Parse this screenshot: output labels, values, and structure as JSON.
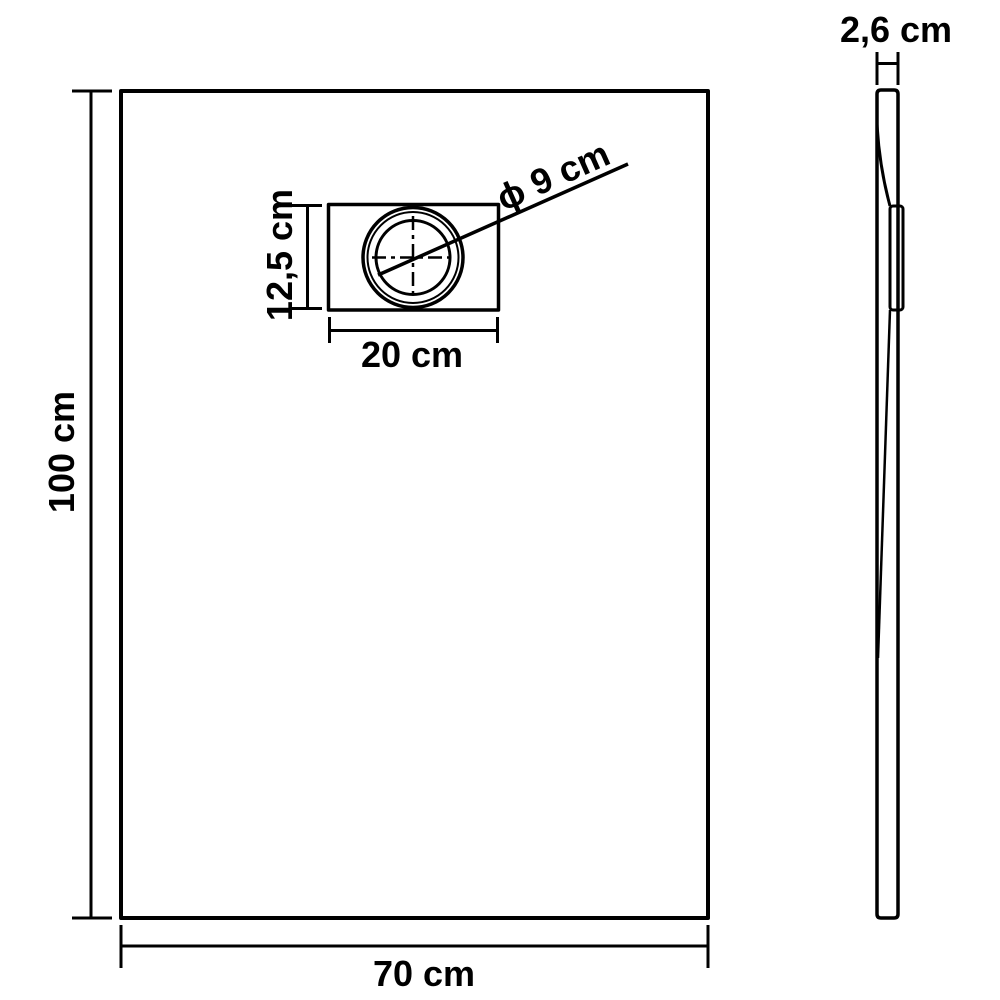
{
  "diagram": {
    "title": "shower tray dimensional drawing",
    "colors": {
      "line": "#000000",
      "background": "#ffffff",
      "text": "#000000"
    },
    "front_view": {
      "height_label": "100 cm",
      "width_label": "70 cm",
      "drain_height_label": "12,5 cm",
      "drain_width_label": "20 cm",
      "drain_diameter_label": "ϕ 9 cm"
    },
    "side_view": {
      "thickness_label": "2,6 cm"
    }
  }
}
